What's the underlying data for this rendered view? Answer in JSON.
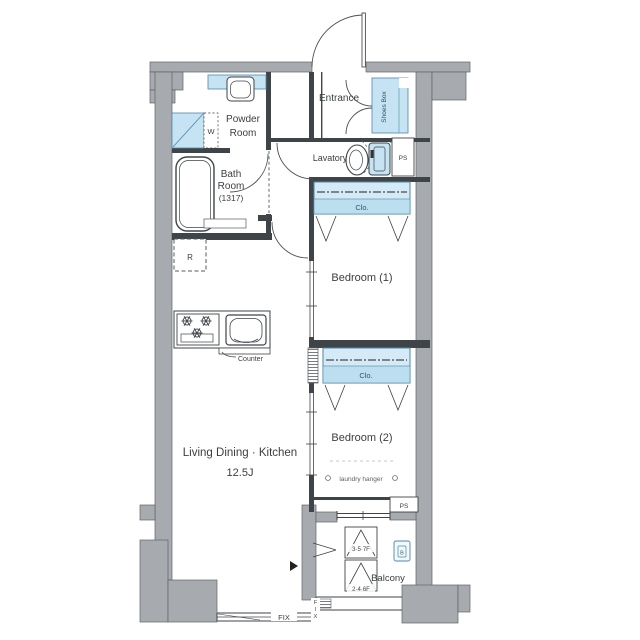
{
  "colors": {
    "wall": "#a7abaf",
    "wallEdge": "#5f6468",
    "line": "#3f4448",
    "aqua": "#c5e3f2",
    "aquaEdge": "#4f87a5",
    "cloFill": "#d4ebf7",
    "cloBand": "#bcdff0",
    "cloText": "#2f5668",
    "text": "#3b3e41",
    "subtext": "#5d6164"
  },
  "labels": {
    "entrance": "Entrance",
    "shoes_box": "Shoes Box",
    "lavatory": "Lavatory",
    "ps": "PS",
    "closet": "Clo.",
    "bedroom1": "Bedroom (1)",
    "bedroom2": "Bedroom (2)",
    "laundry_hanger": "laundry hanger",
    "powder_line1": "Powder",
    "powder_line2": "Room",
    "bath_line1": "Bath",
    "bath_line2": "Room",
    "bath_line3": "(1317)",
    "washer": "W",
    "fridge": "R",
    "counter": "Counter",
    "ldk": "Living Dining · Kitchen",
    "ldk_size": "12.5J",
    "balcony": "Balcony",
    "drain": "B",
    "hatch_upper": "3·5·7F",
    "hatch_lower": "2·4·6F",
    "fix": "FIX",
    "fix_v1": "F",
    "fix_v2": "I",
    "fix_v3": "X"
  }
}
